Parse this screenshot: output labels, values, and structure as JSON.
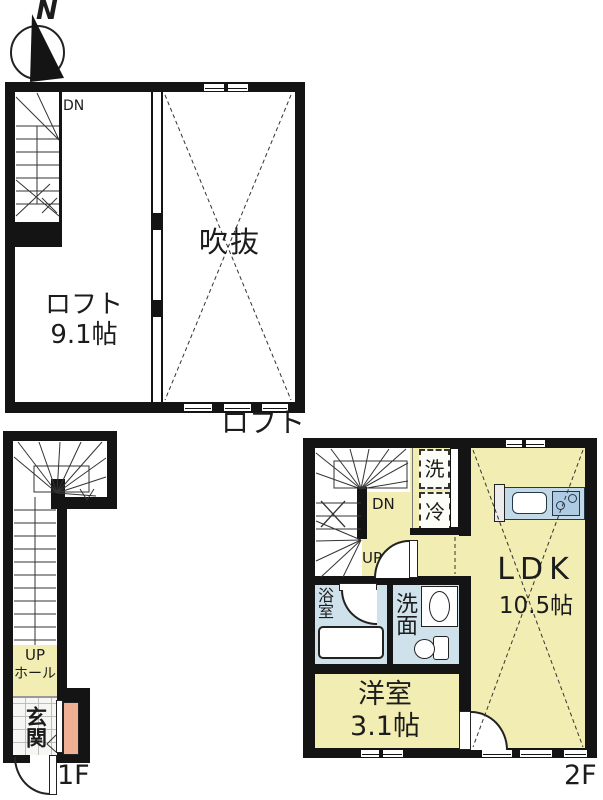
{
  "compass": {
    "north_label": "N"
  },
  "loft": {
    "caption": "ロフト",
    "stairs_down": "DN",
    "room_name": "ロフト",
    "room_size": "9.1帖",
    "void_name": "吹抜"
  },
  "floor1": {
    "caption": "1F",
    "stairs_up": "UP",
    "hall": "ホール",
    "entrance": "玄関"
  },
  "floor2": {
    "caption": "2F",
    "stairs_down": "DN",
    "stairs_up": "UP",
    "washer": "洗",
    "fridge": "冷",
    "ldk_name": "LDK",
    "ldk_size": "10.5帖",
    "bathroom": "浴室",
    "washroom": "洗面",
    "bedroom_name": "洋室",
    "bedroom_size": "3.1帖"
  },
  "colors": {
    "wall": "#141414",
    "floor_yellow": "#f2edb2",
    "wet_area_blue": "#cfe1ea",
    "counter_blue": "#c2d9e8",
    "entry_door_salmon": "#efb093"
  }
}
